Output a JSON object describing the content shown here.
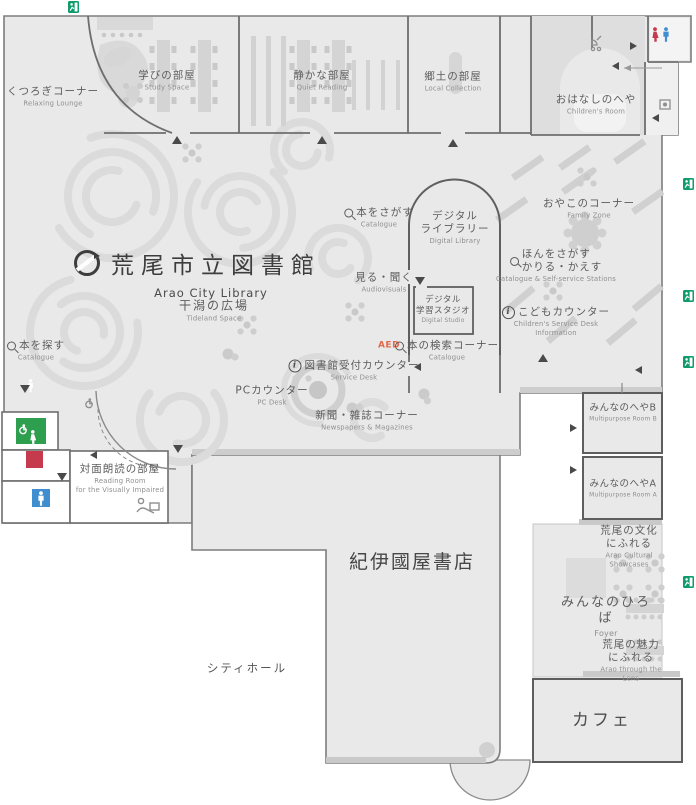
{
  "map": {
    "title": {
      "ja": "荒尾市立図書館",
      "en": "Arao City Library"
    },
    "areas": {
      "relaxing_lounge": {
        "ja": "くつろぎコーナー",
        "en": "Relaxing Lounge"
      },
      "study_space": {
        "ja": "学びの部屋",
        "en": "Study Space"
      },
      "quiet_reading": {
        "ja": "静かな部屋",
        "en": "Quiet Reading"
      },
      "local_collection": {
        "ja": "郷土の部屋",
        "en": "Local Collection"
      },
      "childrens_room": {
        "ja": "おはなしのへや",
        "en": "Children's Room"
      },
      "digital_library": {
        "ja": "デジタル\nライブラリー",
        "en": "Digital Library"
      },
      "audiovisuals": {
        "ja": "見る・聞く",
        "en": "Audiovisuals"
      },
      "digital_studio": {
        "ja": "デジタル\n学習スタジオ",
        "en": "Digital Studio"
      },
      "catalogue_north": {
        "ja": "本をさがす",
        "en": "Catalogue"
      },
      "catalogue_corner": {
        "ja": "本の検索コーナー",
        "en": "Catalogue"
      },
      "catalogue_west": {
        "ja": "本を探す",
        "en": "Catalogue"
      },
      "family_zone": {
        "ja": "おやこのコーナー",
        "en": "Family Zone"
      },
      "self_service": {
        "ja": "ほんをさがす\nかりる・かえす",
        "en": "Catalogue & Self-service Stations"
      },
      "kids_counter": {
        "ja": "こどもカウンター",
        "en": "Children's Service Desk\nInformation"
      },
      "service_desk": {
        "ja": "図書館受付カウンター",
        "en": "Service Desk"
      },
      "pc_desk": {
        "ja": "PCカウンター",
        "en": "PC Desk"
      },
      "newspapers": {
        "ja": "新聞・雑誌コーナー",
        "en": "Newspapers & Magazines"
      },
      "tideland_space": {
        "ja": "干潟の広場",
        "en": "Tideland Space"
      },
      "reading_room": {
        "ja": "対面朗読の部屋",
        "en": "Reading Room\nfor the Visually Impaired"
      },
      "multipurpose_b": {
        "ja": "みんなのへやB",
        "en": "Multipurpose Room B"
      },
      "multipurpose_a": {
        "ja": "みんなのへやA",
        "en": "Multipurpose Room A"
      },
      "cultural_showcases": {
        "ja": "荒尾の文化にふれる",
        "en": "Arao Cultural Showcases"
      },
      "foyer": {
        "ja": "みんなのひろば",
        "en": "Foyer"
      },
      "through_the_lens": {
        "ja": "荒尾の魅力にふれる",
        "en": "Arao through the Lens"
      },
      "bookstore": {
        "ja": "紀伊國屋書店"
      },
      "city_hall": {
        "ja": "シティホール"
      },
      "cafe": {
        "ja": "カフェ"
      }
    },
    "markers": {
      "aed": "AED"
    },
    "icons": {
      "exit": "emergency-exit-icon",
      "search": "search-icon",
      "info": "info-icon",
      "toilet_female": "female-toilet-icon",
      "toilet_male": "male-toilet-icon",
      "accessible": "accessible-toilet-icon"
    },
    "colors": {
      "floor": "#e9e9e9",
      "wall": "#6e6e6e",
      "exit_green": "#0f9b6a",
      "toilet_red": "#c63a4e",
      "toilet_blue": "#3e8ed0",
      "accessible_green": "#2e9e4f",
      "aed_orange": "#e06a4c"
    }
  }
}
